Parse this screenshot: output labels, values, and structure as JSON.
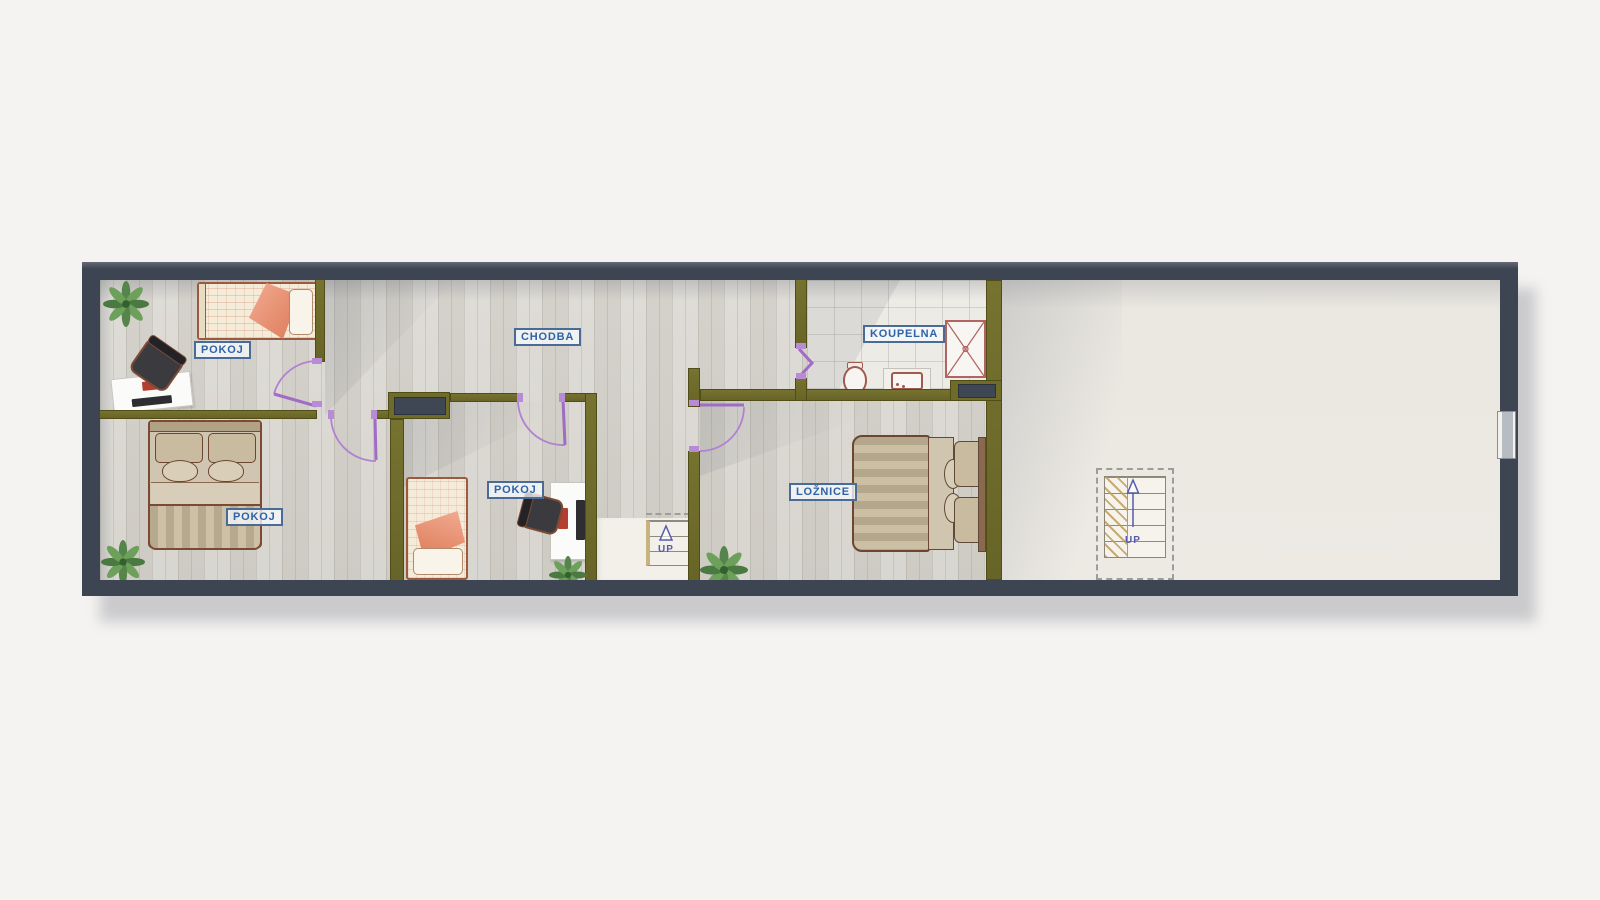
{
  "floorplan": {
    "rooms": [
      {
        "id": "pokoj-1",
        "label": "POKOJ"
      },
      {
        "id": "chodba",
        "label": "CHODBA"
      },
      {
        "id": "koupelna",
        "label": "KOUPELNA"
      },
      {
        "id": "pokoj-2",
        "label": "POKOJ"
      },
      {
        "id": "pokoj-3",
        "label": "POKOJ"
      },
      {
        "id": "loznice",
        "label": "LOŽNICE"
      }
    ],
    "stairs": {
      "middle": {
        "label": "UP"
      },
      "right": {
        "label": "UP"
      }
    },
    "colors": {
      "background": "#f4f3f1",
      "outer_wall": "#3d4553",
      "inner_wall": "#6f6c2a",
      "door": "#b181d2",
      "label_text": "#2f63a8",
      "stairs_text": "#575ba8",
      "wood_floor": "#d7d4ce",
      "accent_blanket": "#ee8f6c"
    },
    "icons": [
      "single-bed",
      "double-bed",
      "desk",
      "office-chair",
      "plant",
      "toilet",
      "sink",
      "shower",
      "staircase",
      "window",
      "door-swing"
    ]
  }
}
